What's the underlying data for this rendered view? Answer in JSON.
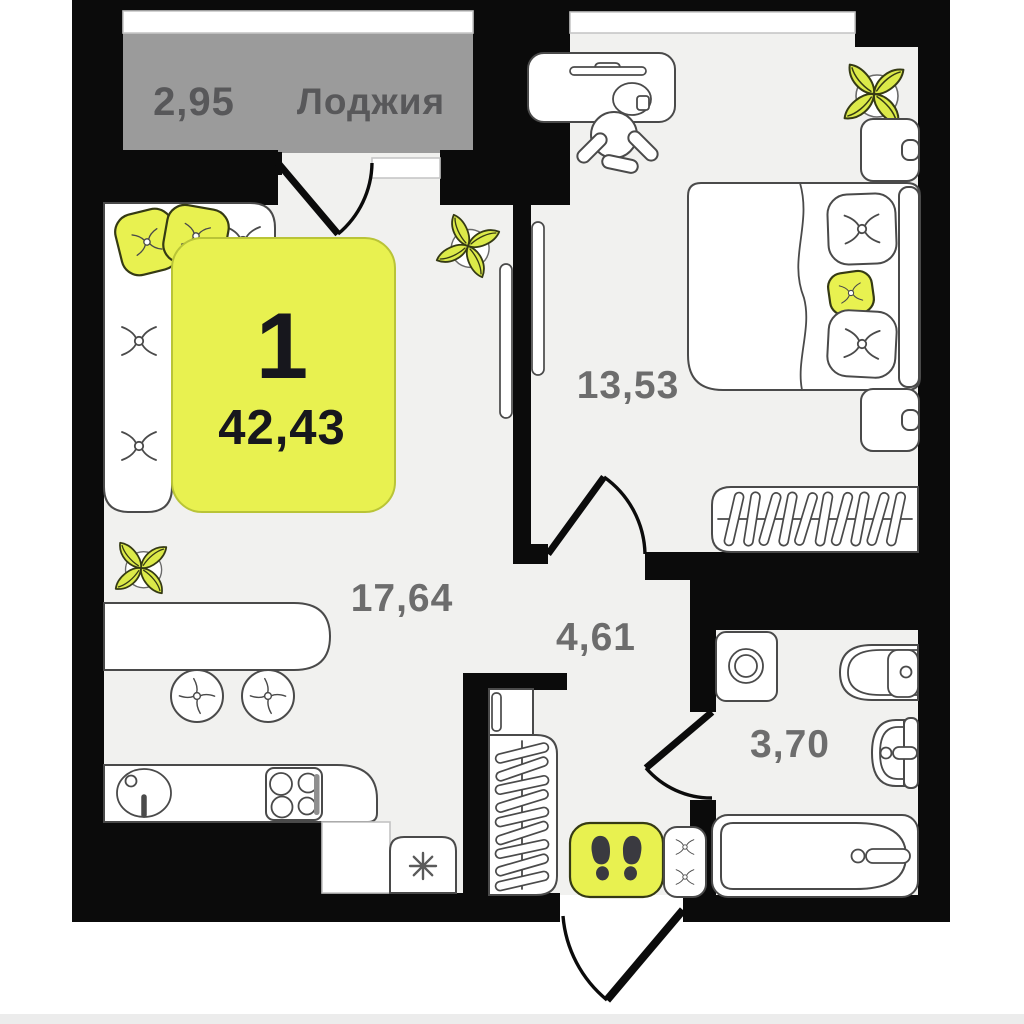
{
  "plan_title": "apartment floor plan",
  "loggia": {
    "area": "2,95",
    "name": "Лоджия"
  },
  "badge": {
    "rooms_count": "1",
    "total_area": "42,43"
  },
  "rooms": {
    "bedroom": {
      "area": "13,53"
    },
    "kitchen_living": {
      "area": "17,64"
    },
    "hallway": {
      "area": "4,61"
    },
    "bathroom": {
      "area": "3,70"
    }
  },
  "icons": {
    "fridge": "snowflake-asterisk",
    "entry_mat": "footprints",
    "wardrobes": "hangers",
    "plants": "four-leaf-plant"
  },
  "colors": {
    "wall": "#0b0b0b",
    "floor": "#f1f1ef",
    "loggia_fill": "#9b9b9b",
    "accent_yellow": "#e8f150",
    "plant_leaf": "#dcea49",
    "outline": "#4a4a4a",
    "room_label": "#6d6d6d",
    "loggia_label": "#58585a",
    "badge_text": "#17171d",
    "footprint": "#3a3a40"
  }
}
